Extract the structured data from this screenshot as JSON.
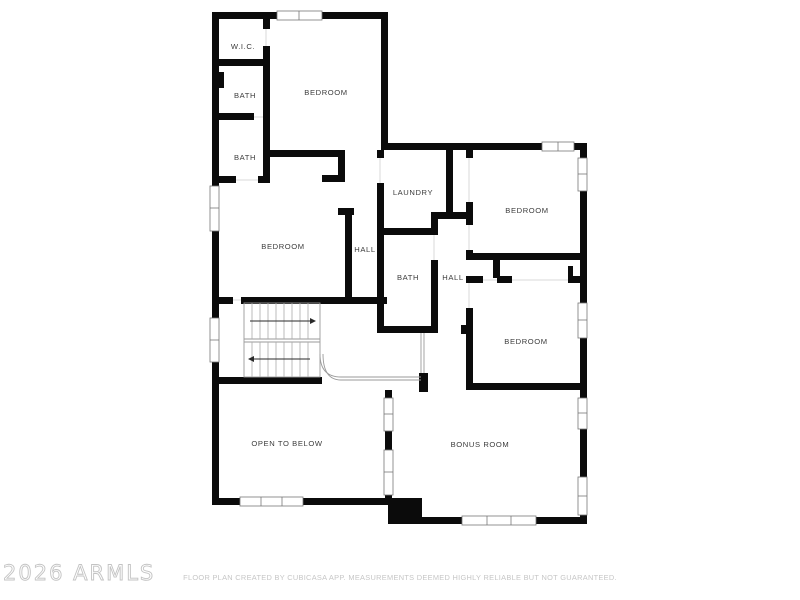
{
  "plan": {
    "rooms": [
      {
        "id": "wic",
        "label": "W.I.C."
      },
      {
        "id": "bath-1",
        "label": "BATH"
      },
      {
        "id": "bedroom-1",
        "label": "BEDROOM"
      },
      {
        "id": "bath-2",
        "label": "BATH"
      },
      {
        "id": "bedroom-2",
        "label": "BEDROOM"
      },
      {
        "id": "hall-1",
        "label": "HALL"
      },
      {
        "id": "laundry",
        "label": "LAUNDRY"
      },
      {
        "id": "bedroom-3",
        "label": "BEDROOM"
      },
      {
        "id": "bath-3",
        "label": "BATH"
      },
      {
        "id": "hall-2",
        "label": "HALL"
      },
      {
        "id": "bedroom-4",
        "label": "BEDROOM"
      },
      {
        "id": "open-to-below",
        "label": "OPEN TO BELOW"
      },
      {
        "id": "bonus-room",
        "label": "BONUS ROOM"
      }
    ]
  },
  "watermark": "2026 ARMLS",
  "disclaimer": "FLOOR PLAN CREATED BY CUBICASA APP. MEASUREMENTS DEEMED HIGHLY RELIABLE BUT NOT GUARANTEED.",
  "colors": {
    "background": "#ffffff",
    "wall": "#0b0b0b",
    "stair_line": "#9a9a9a",
    "label_text": "#3c3c3c",
    "watermark_text": "#c3c3c3",
    "disclaimer_text": "#c6c6c6"
  }
}
